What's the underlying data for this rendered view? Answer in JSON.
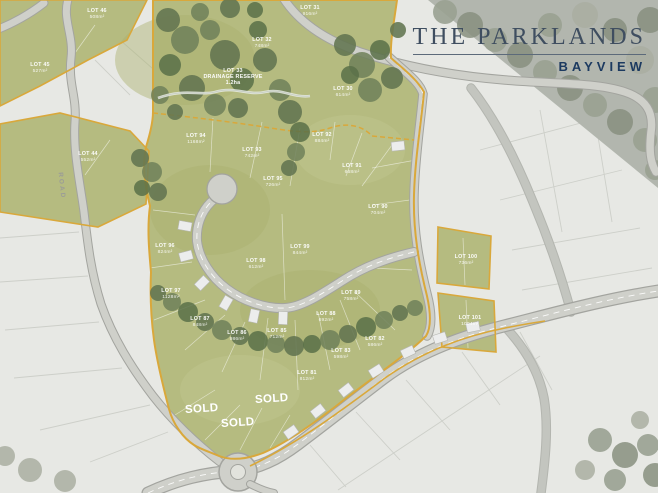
{
  "brand": {
    "title": "THE PARKLANDS",
    "subtitle": "BAYVIEW"
  },
  "map": {
    "road_name": "ROAD",
    "sold_text": "SOLD",
    "sold_markers": [
      {
        "x": 202,
        "y": 412
      },
      {
        "x": 272,
        "y": 402
      },
      {
        "x": 238,
        "y": 426
      }
    ],
    "reserve_label": {
      "x": 233,
      "y": 72,
      "lines": [
        "LOT 33",
        "DRAINAGE RESERVE",
        "1.2ha"
      ]
    },
    "lots": [
      {
        "x": 97,
        "y": 12,
        "lot": "LOT 46",
        "area": "508m²"
      },
      {
        "x": 40,
        "y": 66,
        "lot": "LOT 45",
        "area": "527m²"
      },
      {
        "x": 88,
        "y": 155,
        "lot": "LOT 44",
        "area": "552m²"
      },
      {
        "x": 262,
        "y": 41,
        "lot": "LOT 32",
        "area": "748m²"
      },
      {
        "x": 310,
        "y": 9,
        "lot": "LOT 31",
        "area": "916m²"
      },
      {
        "x": 343,
        "y": 90,
        "lot": "LOT 30",
        "area": "614m²"
      },
      {
        "x": 196,
        "y": 137,
        "lot": "LOT 94",
        "area": "1168m²"
      },
      {
        "x": 252,
        "y": 151,
        "lot": "LOT 93",
        "area": "742m²"
      },
      {
        "x": 322,
        "y": 136,
        "lot": "LOT 92",
        "area": "884m²"
      },
      {
        "x": 352,
        "y": 167,
        "lot": "LOT 91",
        "area": "668m²"
      },
      {
        "x": 378,
        "y": 208,
        "lot": "LOT 90",
        "area": "704m²"
      },
      {
        "x": 273,
        "y": 180,
        "lot": "LOT 95",
        "area": "726m²"
      },
      {
        "x": 165,
        "y": 247,
        "lot": "LOT 96",
        "area": "824m²"
      },
      {
        "x": 171,
        "y": 292,
        "lot": "LOT 97",
        "area": "1128m²"
      },
      {
        "x": 256,
        "y": 262,
        "lot": "LOT 98",
        "area": "612m²"
      },
      {
        "x": 300,
        "y": 248,
        "lot": "LOT 99",
        "area": "844m²"
      },
      {
        "x": 351,
        "y": 294,
        "lot": "LOT 89",
        "area": "758m²"
      },
      {
        "x": 326,
        "y": 315,
        "lot": "LOT 88",
        "area": "692m²"
      },
      {
        "x": 200,
        "y": 320,
        "lot": "LOT 87",
        "area": "848m²"
      },
      {
        "x": 237,
        "y": 334,
        "lot": "LOT 86",
        "area": "986m²"
      },
      {
        "x": 277,
        "y": 332,
        "lot": "LOT 85",
        "area": "712m²"
      },
      {
        "x": 341,
        "y": 352,
        "lot": "LOT 83",
        "area": "598m²"
      },
      {
        "x": 375,
        "y": 340,
        "lot": "LOT 82",
        "area": "586m²"
      },
      {
        "x": 307,
        "y": 374,
        "lot": "LOT 81",
        "area": "812m²"
      },
      {
        "x": 466,
        "y": 258,
        "lot": "LOT 100",
        "area": "736m²"
      },
      {
        "x": 470,
        "y": 319,
        "lot": "LOT 101",
        "area": "1004m²"
      }
    ],
    "colors": {
      "estate_green": "#b5bb80",
      "boundary_gold": "#d9a83b",
      "road_gray": "#cfd0ca",
      "tree_green": "#627450",
      "faded_gray": "#b2b6ae",
      "title_navy": "#3f4e60",
      "subtitle_navy": "#1c3a60"
    }
  }
}
